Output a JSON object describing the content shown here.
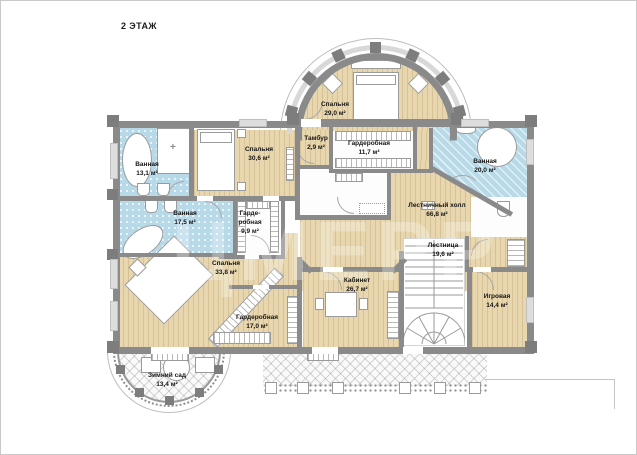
{
  "title": "2 ЭТАЖ",
  "watermark": "ЦМЕРР",
  "floor_plan": {
    "colors": {
      "wall": "#8a8a8a",
      "wood_floor": "#e8d7ae",
      "bathroom_blue": "#b7d9e8",
      "terrace": "#fafafa"
    },
    "rooms": [
      {
        "name": "Ванная",
        "area": "13,1 м²"
      },
      {
        "name": "Спальня",
        "area": "30,6 м²"
      },
      {
        "name": "Спальня",
        "area": "29,0 м²"
      },
      {
        "name": "Тамбур",
        "area": "2,9 м²"
      },
      {
        "name": "Гардеробная",
        "area": "11,7 м²"
      },
      {
        "name": "Ванная",
        "area": "20,0 м²"
      },
      {
        "name": "Ванная",
        "area": "17,5 м²"
      },
      {
        "name": "Гарде-робная",
        "area": "9,9 м²"
      },
      {
        "name": "Спальня",
        "area": "33,8 м²"
      },
      {
        "name": "Гардеробная",
        "area": "17,0 м²"
      },
      {
        "name": "Лестничный холл",
        "area": "66,8 м²"
      },
      {
        "name": "Лестница",
        "area": "19,6 м²"
      },
      {
        "name": "Кабинет",
        "area": "26,7 м²"
      },
      {
        "name": "Игровая",
        "area": "14,4 м²"
      },
      {
        "name": "Зимний сад",
        "area": "13,4 м²"
      }
    ]
  }
}
